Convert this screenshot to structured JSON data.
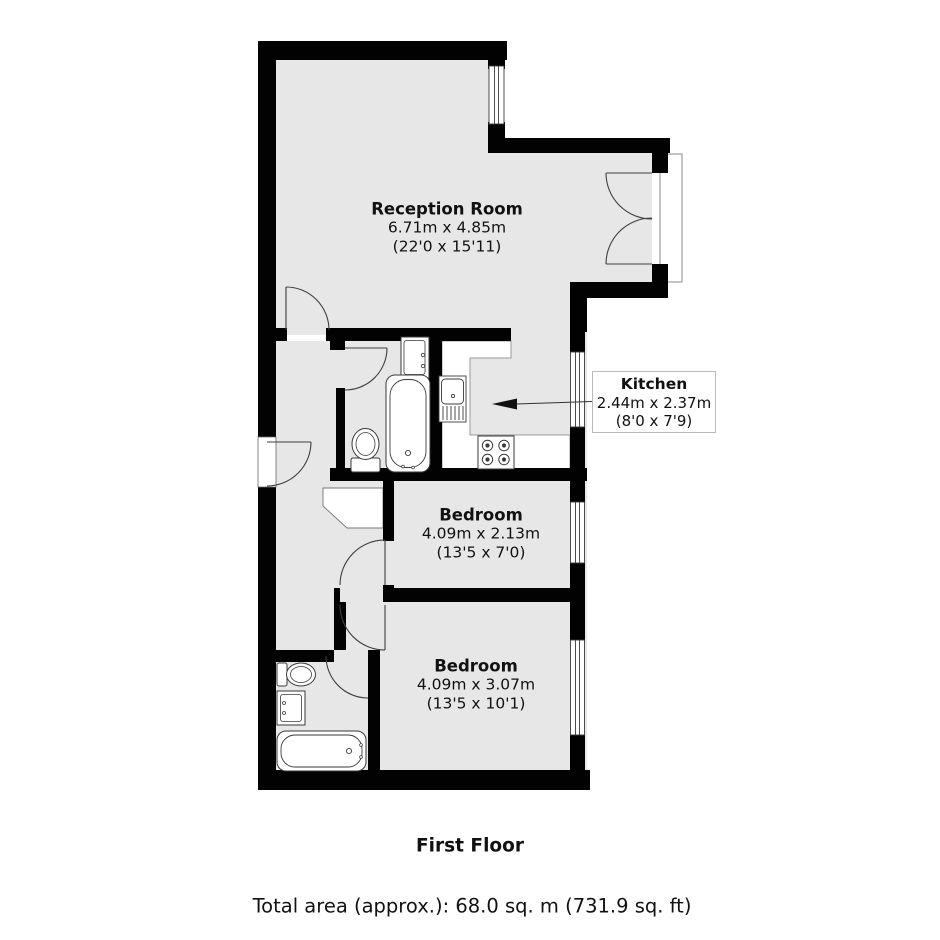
{
  "floorplan": {
    "rooms": [
      {
        "id": "reception",
        "name": "Reception Room",
        "metric": "6.71m x 4.85m",
        "imperial": "(22'0 x 15'11)"
      },
      {
        "id": "kitchen",
        "name": "Kitchen",
        "metric": "2.44m x 2.37m",
        "imperial": "(8'0 x 7'9)"
      },
      {
        "id": "bedroom1",
        "name": "Bedroom",
        "metric": "4.09m x 2.13m",
        "imperial": "(13'5 x 7'0)"
      },
      {
        "id": "bedroom2",
        "name": "Bedroom",
        "metric": "4.09m x 3.07m",
        "imperial": "(13'5 x 10'1)"
      }
    ],
    "floor_title": "First Floor",
    "total_area": "Total area (approx.): 68.0 sq. m (731.9 sq. ft)",
    "colors": {
      "wall": "#020202",
      "floor": "#e7e7e7",
      "line": "#3f3f3f"
    }
  }
}
